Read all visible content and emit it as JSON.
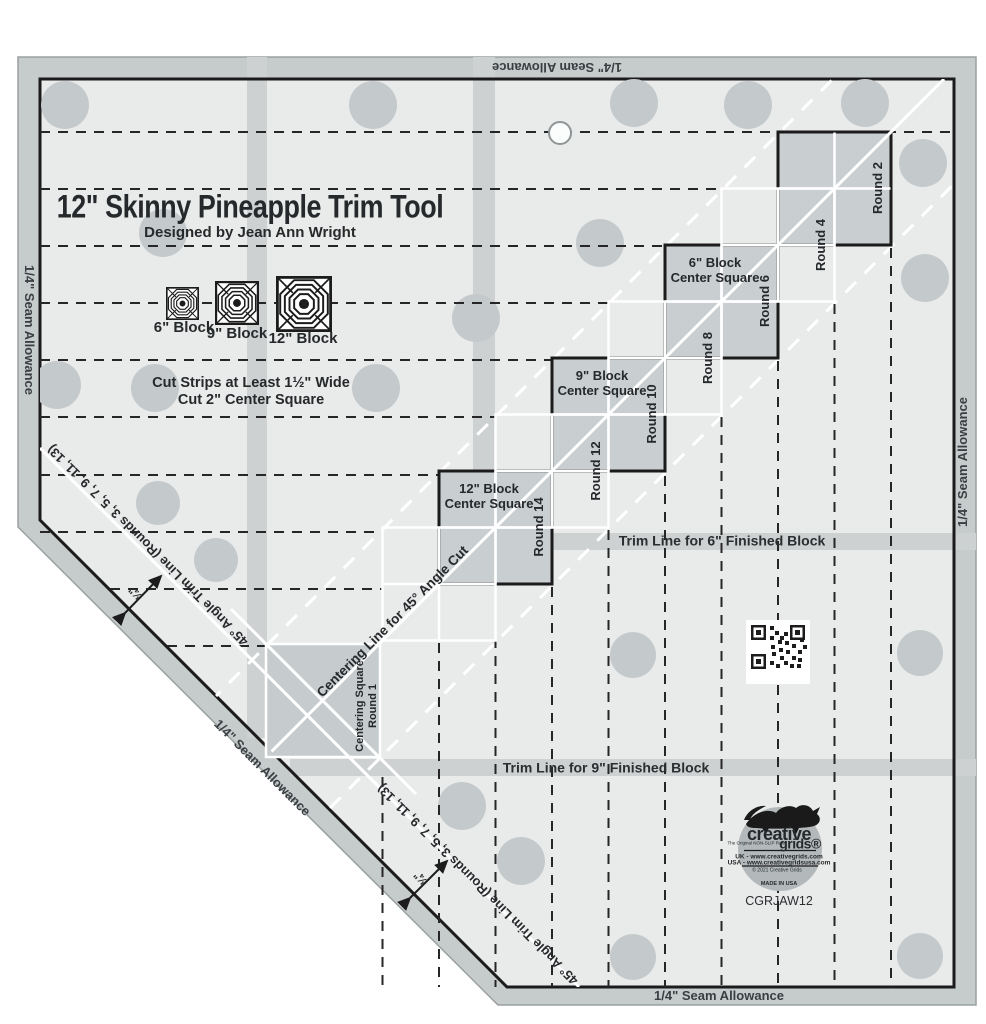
{
  "product": {
    "title": "12\" Skinny Pineapple Trim Tool",
    "subtitle": "Designed by Jean Ann Wright",
    "sku": "CGRJAW12"
  },
  "instructions": {
    "line1": "Cut Strips at Least 1½\" Wide",
    "line2": "Cut 2\" Center Square"
  },
  "block_icons": [
    {
      "label": "6\" Block"
    },
    {
      "label": "9\" Block"
    },
    {
      "label": "12\" Block"
    }
  ],
  "center_squares": {
    "b6_line1": "6\" Block",
    "b6_line2": "Center Square",
    "b9_line1": "9\" Block",
    "b9_line2": "Center Square",
    "b12_line1": "12\" Block",
    "b12_line2": "Center Square"
  },
  "rounds": [
    "Round 2",
    "Round 4",
    "Round 6",
    "Round 8",
    "Round 10",
    "Round 12",
    "Round 14"
  ],
  "centering_square": {
    "line1": "Centering Square",
    "line2": "Round 1"
  },
  "centering_line_label": "Centering Line for 45° Angle Cut",
  "trim_line_6": "Trim Line for 6\" Finished Block",
  "trim_line_9": "Trim Line for 9\" Finished Block",
  "angle_trim_label": "45° Angle Trim Line (Rounds 3, 5, 7, 9, 11, 13)",
  "three_quarter_label": "¾\"",
  "seam_allowance_label": "1/4\" Seam Allowance",
  "logo": {
    "brand_top": "creative",
    "brand_bottom": "grids®",
    "tagline": "The Original NON-SLIP Ruler",
    "uk_url": "UK - www.creativegrids.com",
    "usa_url": "USA - www.creativegridsusa.com",
    "copyright": "© 2021 Creative Grids",
    "made_in": "MADE IN USA"
  },
  "colors": {
    "margin_gray": "#c6cbcc",
    "surface_gray": "#e9eaea",
    "band_gray": "#cdd1d2",
    "square_gray": "#c9cfd0",
    "dot_gray": "#c4cacb",
    "ink_black": "#232629",
    "line_white": "#ffffff"
  }
}
